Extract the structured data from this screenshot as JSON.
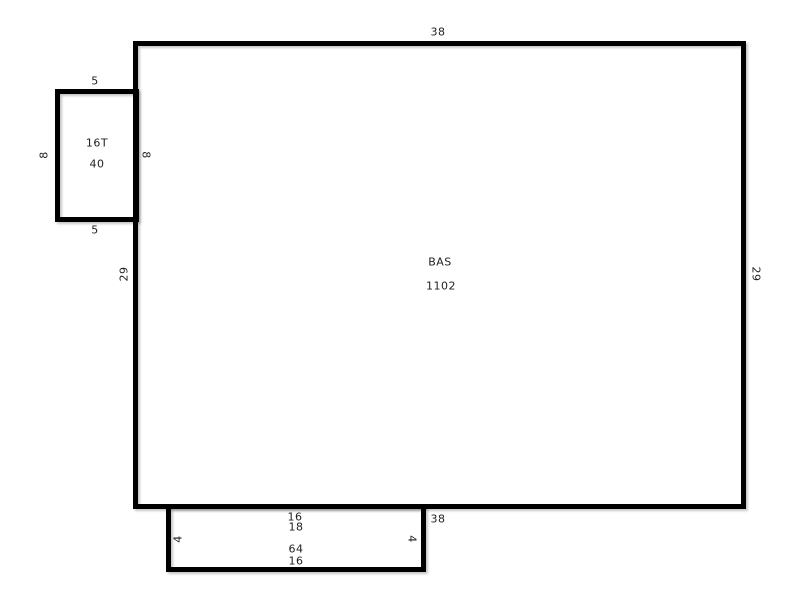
{
  "sketch": {
    "colors": {
      "line": "#000000",
      "text": "#1f1f1f",
      "background": "#ffffff"
    },
    "bas": {
      "name": "BAS",
      "area": "1102",
      "dim_top": "38",
      "dim_bottom": "38",
      "dim_left": "29",
      "dim_right": "29",
      "dim_left_upper": "8"
    },
    "t16": {
      "name": "16T",
      "area": "40",
      "dim_top": "5",
      "dim_bottom": "5",
      "dim_left": "8"
    },
    "addition": {
      "area": "64",
      "dim_top": "16",
      "dim_top2": "18",
      "dim_bottom": "16",
      "dim_left": "4",
      "dim_right": "4"
    }
  }
}
